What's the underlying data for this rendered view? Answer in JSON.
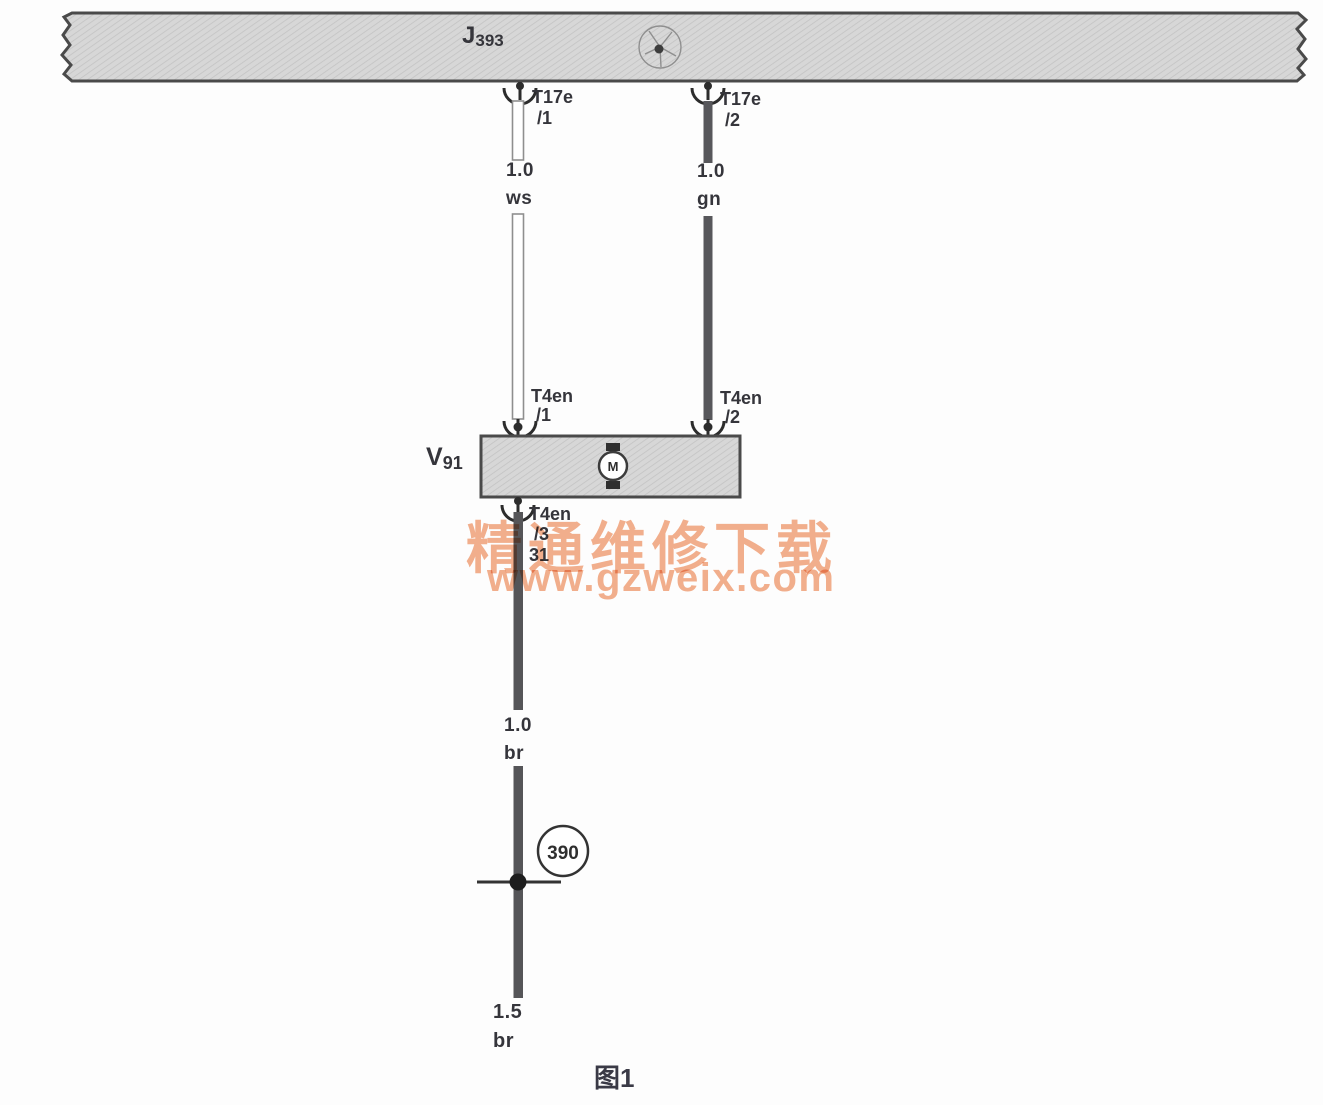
{
  "diagram": {
    "bus": {
      "label_prefix": "J",
      "label_number": "393"
    },
    "connectors": {
      "t17e_1": {
        "name": "T17e",
        "pin": "/1"
      },
      "t17e_2": {
        "name": "T17e",
        "pin": "/2"
      },
      "t4en_1": {
        "name": "T4en",
        "pin": "/1"
      },
      "t4en_2": {
        "name": "T4en",
        "pin": "/2"
      },
      "t4en_3": {
        "name": "T4en",
        "pin": "/3",
        "terminal": "31"
      }
    },
    "wires": {
      "ws": {
        "size": "1.0",
        "color_code": "ws"
      },
      "gn": {
        "size": "1.0",
        "color_code": "gn"
      },
      "br_upper": {
        "size": "1.0",
        "color_code": "br"
      },
      "br_lower": {
        "size": "1.5",
        "color_code": "br"
      }
    },
    "component": {
      "label_prefix": "V",
      "label_number": "91",
      "motor_letter": "M"
    },
    "ground_point": {
      "number": "390"
    },
    "caption": "图1"
  },
  "watermark": {
    "line1": "精通维修下载",
    "line2": "www.gzweix.com"
  },
  "colors": {
    "watermark": "#f2a983",
    "wire_dark": "#57575b",
    "ink": "#35353b",
    "hatch_fill": "#d7d7d7"
  }
}
